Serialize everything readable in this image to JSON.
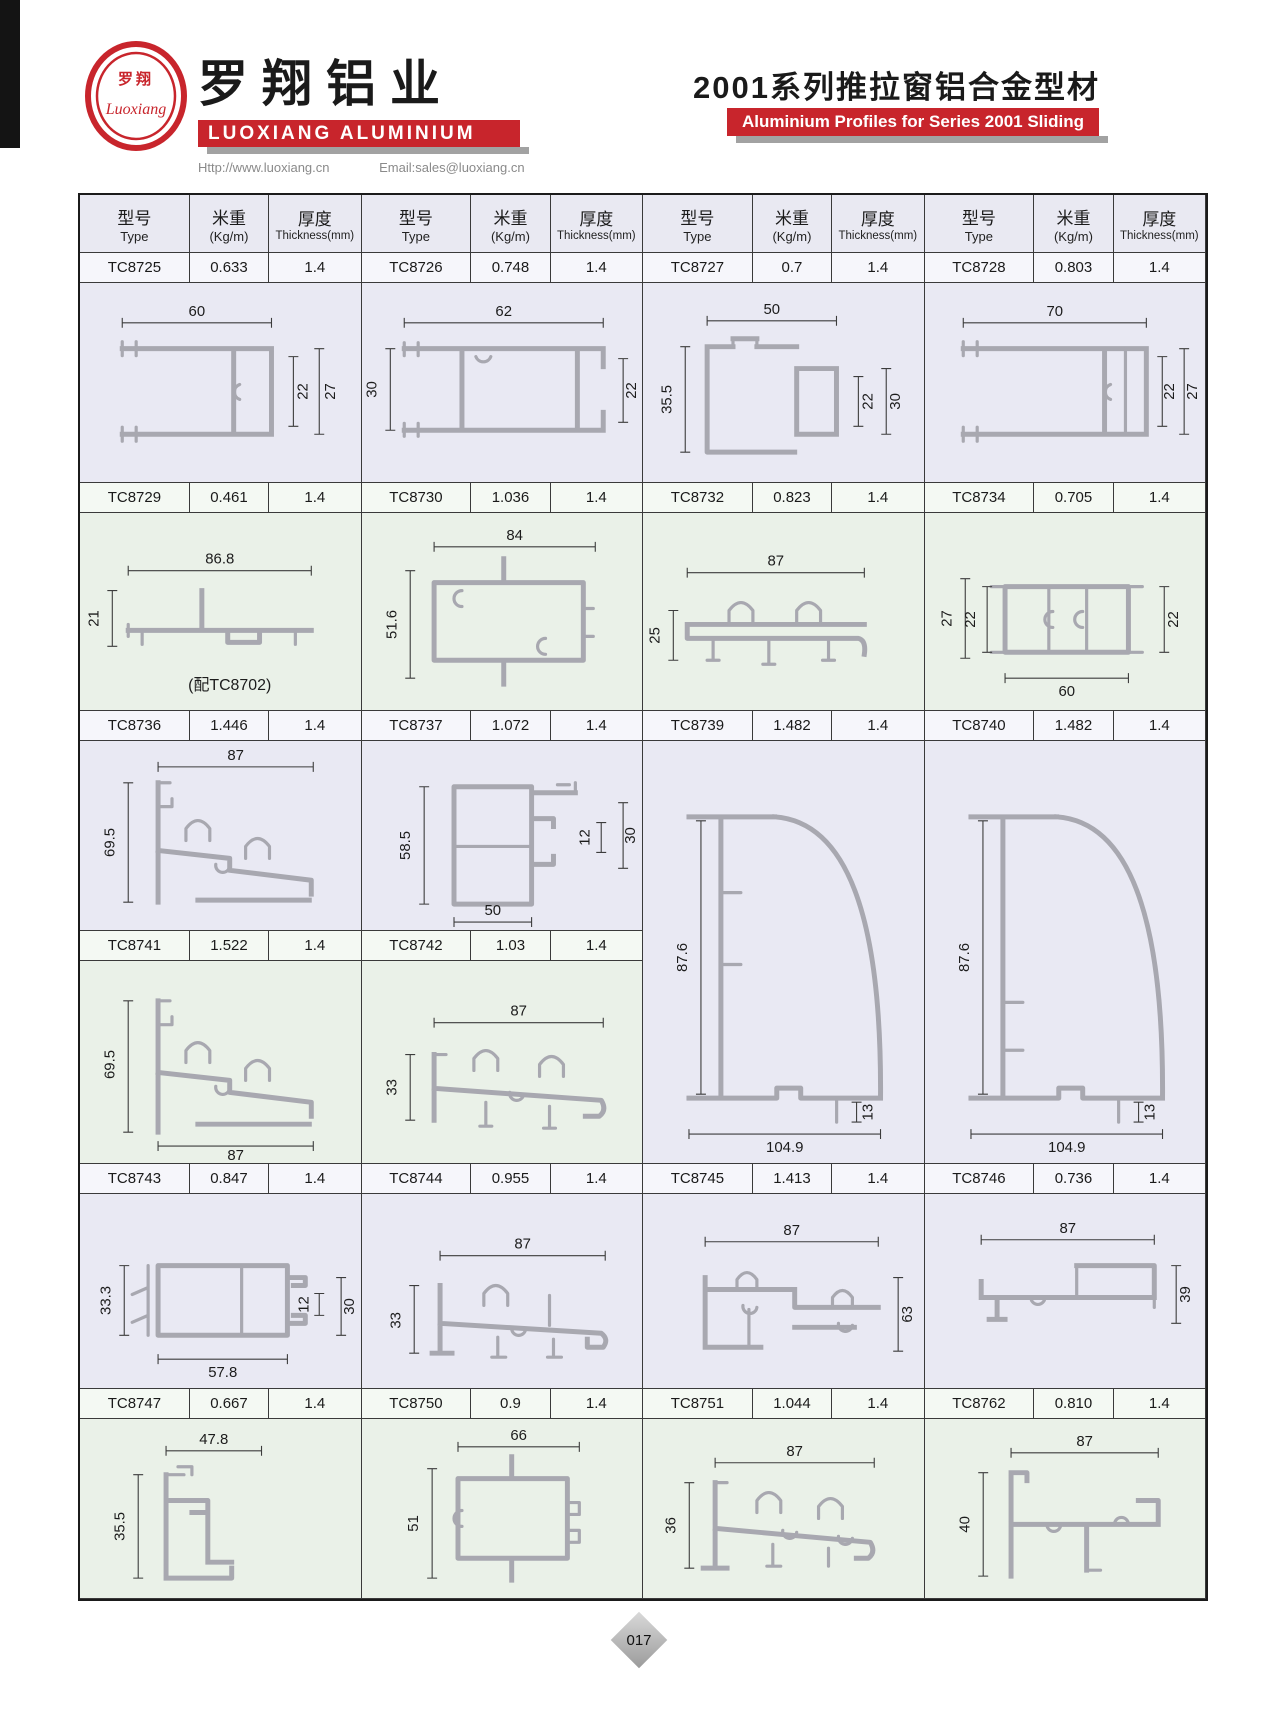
{
  "page": {
    "page_number": "017"
  },
  "header": {
    "logo_cn": "罗翔",
    "logo_script": "Luoxiang",
    "company_cn": "罗翔铝业",
    "company_en": "LUOXIANG ALUMINIUM",
    "website": "Http://www.luoxiang.cn",
    "email": "Email:sales@luoxiang.cn",
    "series_cn": "2001系列推拉窗铝合金型材",
    "series_en": "Aluminium Profiles for Series 2001 Sliding Window"
  },
  "colors": {
    "accent_red": "#c8252c",
    "band_lavender": "#e9e9f3",
    "band_green": "#eaf1e8"
  },
  "table": {
    "headers": {
      "type_cn": "型号",
      "type_en": "Type",
      "weight_cn": "米重",
      "weight_en": "(Kg/m)",
      "thickness_cn": "厚度",
      "thickness_en": "Thickness(mm)"
    },
    "rows": [
      {
        "cells": [
          [
            "TC8725",
            "0.633",
            "1.4"
          ],
          [
            "TC8726",
            "0.748",
            "1.4"
          ],
          [
            "TC8727",
            "0.7",
            "1.4"
          ],
          [
            "TC8728",
            "0.803",
            "1.4"
          ]
        ]
      },
      {
        "cells": [
          [
            "TC8729",
            "0.461",
            "1.4"
          ],
          [
            "TC8730",
            "1.036",
            "1.4"
          ],
          [
            "TC8732",
            "0.823",
            "1.4"
          ],
          [
            "TC8734",
            "0.705",
            "1.4"
          ]
        ]
      },
      {
        "cells": [
          [
            "TC8736",
            "1.446",
            "1.4"
          ],
          [
            "TC8737",
            "1.072",
            "1.4"
          ],
          [
            "TC8739",
            "1.482",
            "1.4"
          ],
          [
            "TC8740",
            "1.482",
            "1.4"
          ]
        ]
      },
      {
        "cells": [
          [
            "TC8741",
            "1.522",
            "1.4"
          ],
          [
            "TC8742",
            "1.03",
            "1.4"
          ]
        ]
      },
      {
        "cells": [
          [
            "TC8743",
            "0.847",
            "1.4"
          ],
          [
            "TC8744",
            "0.955",
            "1.4"
          ],
          [
            "TC8745",
            "1.413",
            "1.4"
          ],
          [
            "TC8746",
            "0.736",
            "1.4"
          ]
        ]
      },
      {
        "cells": [
          [
            "TC8747",
            "0.667",
            "1.4"
          ],
          [
            "TC8750",
            "0.9",
            "1.4"
          ],
          [
            "TC8751",
            "1.044",
            "1.4"
          ],
          [
            "TC8762",
            "0.810",
            "1.4"
          ]
        ]
      }
    ]
  },
  "drawings": {
    "tc8725": {
      "w": "60",
      "h1": "22",
      "h2": "27"
    },
    "tc8726": {
      "w": "62",
      "h1": "30",
      "h2": "22"
    },
    "tc8727": {
      "w": "50",
      "h1": "35.5",
      "h2": "22",
      "h3": "30"
    },
    "tc8728": {
      "w": "70",
      "h1": "22",
      "h2": "27"
    },
    "tc8729": {
      "w": "86.8",
      "h1": "21",
      "note": "(配TC8702)"
    },
    "tc8730": {
      "w": "84",
      "h1": "51.6"
    },
    "tc8732": {
      "w": "87",
      "h1": "25"
    },
    "tc8734": {
      "h1": "27",
      "h2": "22",
      "h3": "22",
      "b": "60"
    },
    "tc8736": {
      "w": "87",
      "h1": "69.5"
    },
    "tc8737": {
      "h1": "58.5",
      "h2": "12",
      "h3": "30",
      "b": "50"
    },
    "tc8739": {
      "h1": "87.6",
      "h2": "13",
      "b": "104.9"
    },
    "tc8740": {
      "h1": "87.6",
      "h2": "13",
      "b": "104.9"
    },
    "tc8741": {
      "h1": "69.5",
      "b": "87"
    },
    "tc8742": {
      "w": "87",
      "h1": "33"
    },
    "tc8743": {
      "h1": "33.3",
      "h2": "12",
      "h3": "30",
      "b": "57.8"
    },
    "tc8744": {
      "w": "87",
      "h1": "33"
    },
    "tc8745": {
      "w": "87",
      "h1": "63"
    },
    "tc8746": {
      "w": "87",
      "h1": "39"
    },
    "tc8747": {
      "w": "47.8",
      "h1": "35.5"
    },
    "tc8750": {
      "w": "66",
      "h1": "51"
    },
    "tc8751": {
      "w": "87",
      "h1": "36"
    },
    "tc8762": {
      "w": "87",
      "h1": "40"
    }
  }
}
